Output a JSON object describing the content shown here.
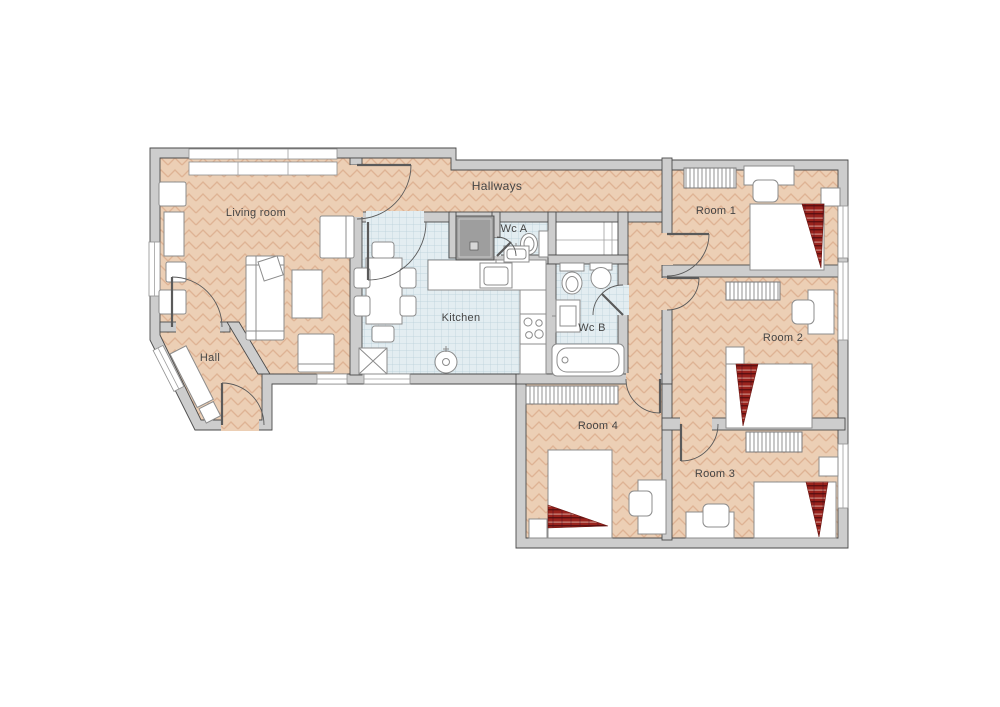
{
  "title": "Apartment floor plan",
  "rooms": {
    "living_room": {
      "label": "Living room"
    },
    "hall": {
      "label": "Hall"
    },
    "hallways": {
      "label": "Hallways"
    },
    "kitchen": {
      "label": "Kitchen"
    },
    "wc_a": {
      "label": "Wc A"
    },
    "wc_b": {
      "label": "Wc B"
    },
    "room1": {
      "label": "Room 1"
    },
    "room2": {
      "label": "Room 2"
    },
    "room3": {
      "label": "Room 3"
    },
    "room4": {
      "label": "Room 4"
    }
  },
  "theme": {
    "background": "#ffffff",
    "wall_fill": "#cdcdcd",
    "wall_stroke": "#4a4a4a",
    "wood_floor": "#eccfb5",
    "wood_grain": "#c8875f",
    "tile_floor": "#e3edf1",
    "tile_grid": "#b9cfd9",
    "furniture_fill": "#ffffff",
    "furniture_stroke": "#8c8c8c",
    "shower_fill": "#9e9e9e",
    "blanket_red": "#9a231d",
    "blanket_dark": "#5f1010",
    "label_color": "#454545"
  }
}
